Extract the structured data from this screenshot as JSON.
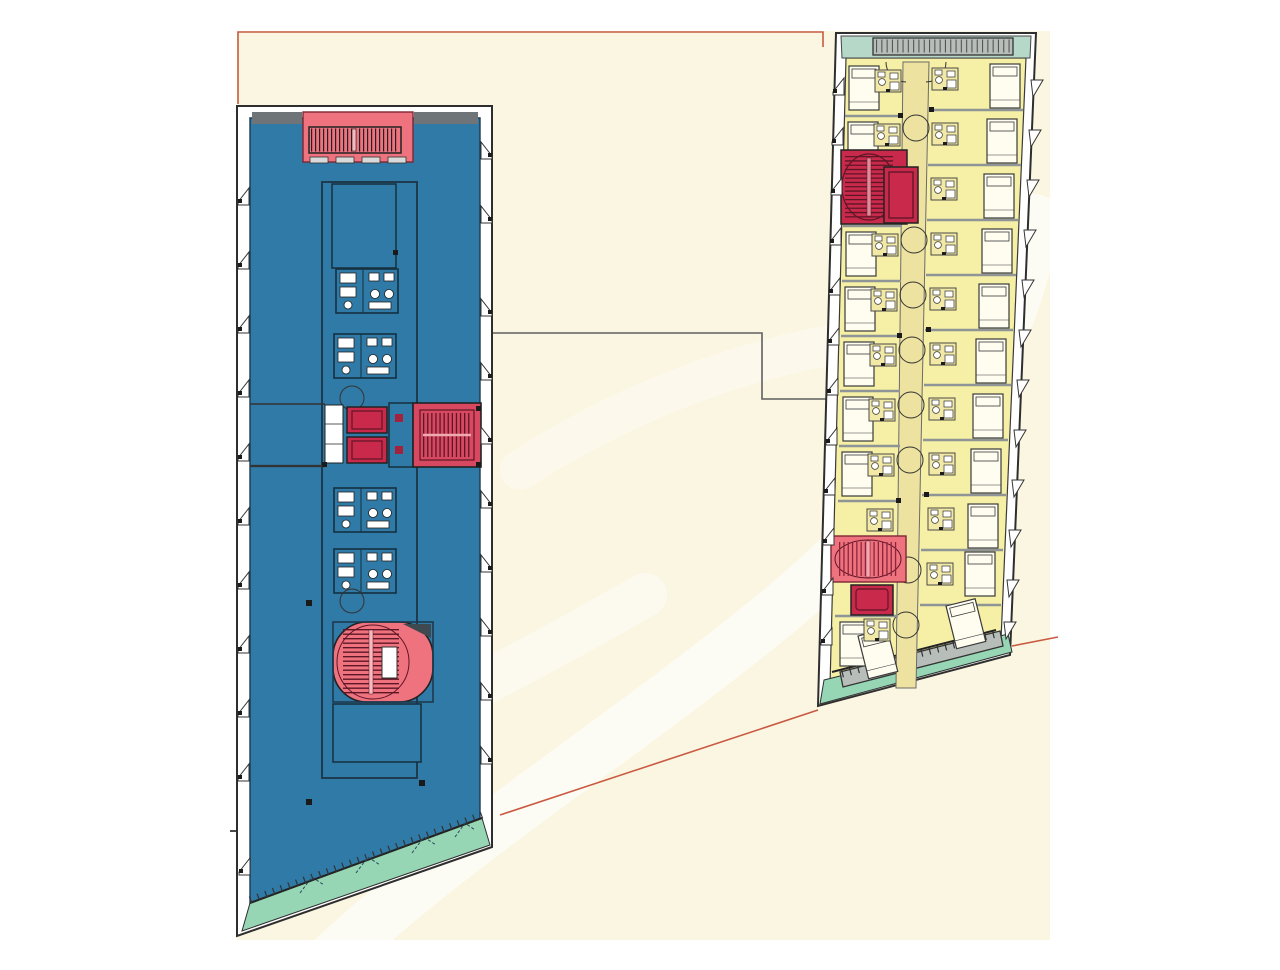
{
  "canvas": {
    "width": 1280,
    "height": 970
  },
  "document_kind": "architectural-floor-plan-drawing",
  "colors": {
    "page_bg": "#ffffff",
    "paper_cream": "#fbf6e1",
    "watermark_white": "#ffffff",
    "office_floor_blue": "#2f7aa6",
    "hotel_floor_yellow": "#f6efa6",
    "corridor_tan": "#ede2a0",
    "stair_pink": "#ef727f",
    "stair_red": "#c9294a",
    "terrace_mint": "#96d6b4",
    "canopy_mint": "#b6d8c9",
    "hatch_gray": "#b7beb9",
    "partition_gray": "#8f9596",
    "wall_dark": "#2e2e2e",
    "guide_red": "#c95a42",
    "connector_gray": "#5f5f5f",
    "poche_gray": "#6e7477"
  },
  "plans": {
    "left_plan": {
      "id": "office-tower-floor-plan",
      "floor_color_key": "office_floor_blue",
      "cores": [
        "top-stair-core",
        "central-elevator-core",
        "mid-stair-core",
        "oval-stair-core"
      ],
      "elevators": 2,
      "restroom_pods": 4,
      "terrace_edge": "slanted-bottom-mint-strip"
    },
    "right_plan": {
      "id": "hotel-tower-floor-plan",
      "floor_color_key": "hotel_floor_yellow",
      "cores": [
        "upper-stair-core",
        "upper-elevator",
        "lower-stair-core",
        "lower-elevator"
      ],
      "guest_room_rows_left": 9,
      "guest_room_rows_right": 11,
      "corridor": "central-vertical",
      "canopy_edge_top": true,
      "terrace_edge_bottom": "slanted-hatched-band"
    }
  },
  "annotations": {
    "connector_line": "stepped gray line linking office core level to hotel corridor level",
    "guide_line_top": "red projection line joining top-left corners of both plans",
    "guide_line_bottom": "red diagonal projection line joining bottom corners of both plans",
    "reference_dash": "short gray datum tick left of office plan"
  }
}
